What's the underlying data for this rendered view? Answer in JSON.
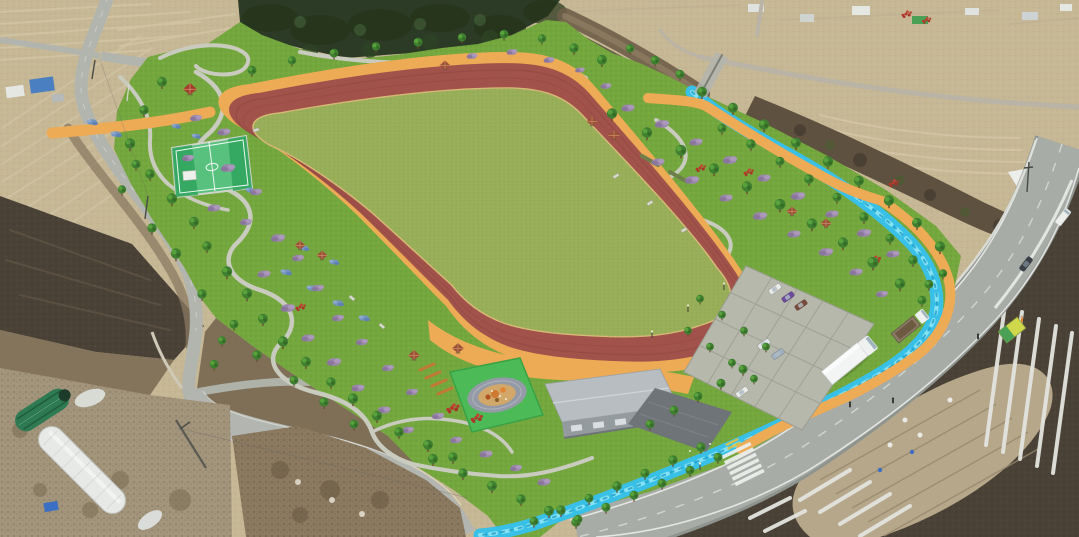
{
  "meta": {
    "title": "aerial-park-rendering",
    "description": "Oblique aerial photomontage of a planned rural sports park: red running track around a grass infield, orange perimeter paths, landscaped flower gardens, basketball court, playground, maintenance building, parking lot and a blue stream channel, surrounded by farm fields, greenhouses and country roads",
    "image_width": 1079,
    "image_height": 537
  },
  "colors": {
    "farmland": "#c6b795",
    "furrow": "#d8ccab",
    "soil_dark": "#4a4237",
    "soil_mid": "#7a6a52",
    "scrub": "#5e5140",
    "forest": "#2c3b26",
    "lawn": "#74a73e",
    "infield": "#98ae58",
    "track": "#a1524a",
    "track_line": "#8a4540",
    "path_orange": "#edab55",
    "walkway": "#c9cbbf",
    "stream": "#38c0e6",
    "stream_light": "#8ee4f5",
    "stream_dark": "#1f9ec6",
    "road": "#a8aca7",
    "road_minor": "#b2b5ae",
    "paver": "#b6b8ac",
    "roof": "#b7bdc0",
    "wall": "#949b9f",
    "plaza": "#6e7477",
    "court": "#58c17e",
    "court_key": "#2fa45c",
    "mat": "#4cba57",
    "oval": "#949aa6",
    "sand": "#d2a86a",
    "greenhouse": "#e7e9e6",
    "greenhouse_green": "#2e7a52",
    "shrub": "#9b87ab",
    "flower_blue": "#7593c0",
    "flower_red": "#b5382a",
    "canopy": "#3f8030",
    "trunk": "#6b4a2f",
    "truck": "#f3f5f4",
    "marking": "#eef0ee",
    "caution": "#e3c23d",
    "knoll": "#8b7a5f"
  },
  "objects": {
    "park_features": [
      "running-track",
      "infield-lawn",
      "perimeter-path",
      "basketball-court",
      "playground",
      "maintenance-building",
      "entrance-plaza",
      "parking-lot",
      "stream-channel",
      "garden-walking-paths",
      "flower-beds",
      "pavilions"
    ],
    "surroundings": [
      "pine-forest",
      "farm-fields",
      "plastic-mulch-rows",
      "greenhouses",
      "country-road",
      "main-road",
      "crosswalk",
      "utility-poles",
      "white-tent"
    ],
    "vehicles": [
      {
        "type": "box-truck",
        "color": "white"
      },
      {
        "type": "flatbed-truck",
        "color": "white-brown"
      },
      {
        "type": "sedan",
        "color": "dark-gray"
      },
      {
        "type": "van",
        "color": "white"
      },
      {
        "type": "parked-car",
        "color": "white"
      },
      {
        "type": "parked-car",
        "color": "purple"
      },
      {
        "type": "parked-car",
        "color": "dark-red"
      },
      {
        "type": "parked-car",
        "color": "silver-blue"
      },
      {
        "type": "parked-car",
        "color": "white"
      },
      {
        "type": "parked-car",
        "color": "white"
      }
    ],
    "people_count": 4,
    "pavilion_count": 10
  }
}
